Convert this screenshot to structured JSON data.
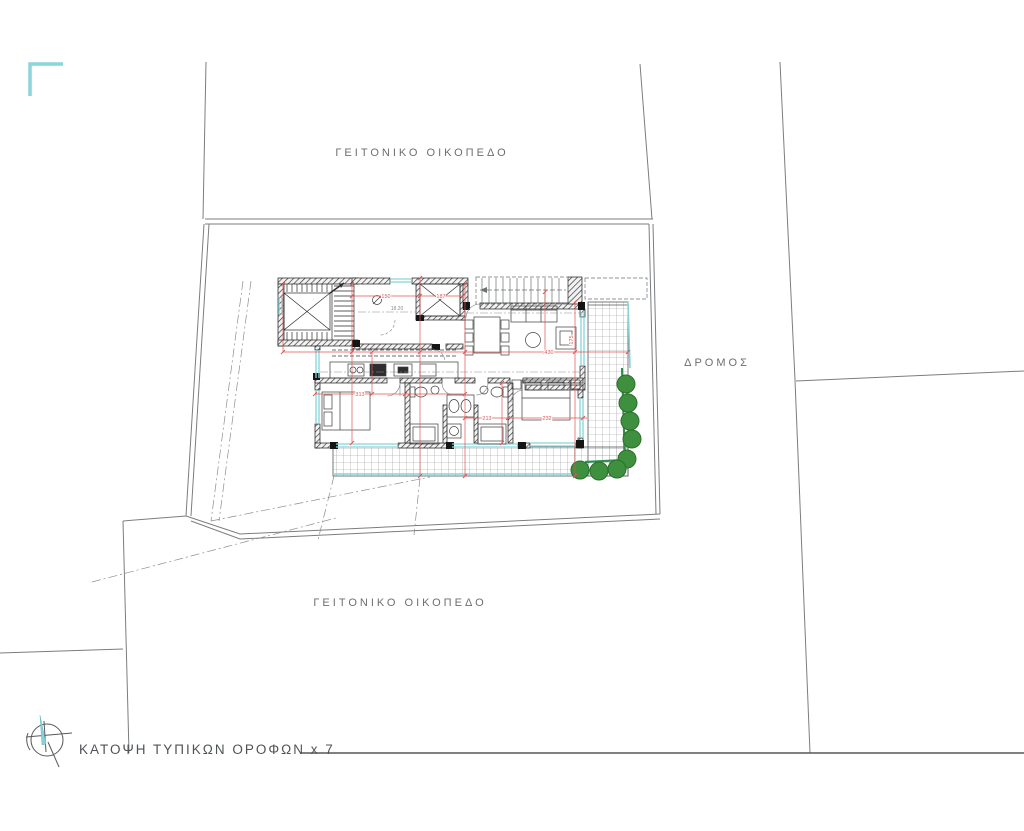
{
  "labels": {
    "neighbor_top": "ΓΕΙΤΟΝΙΚΟ ΟΙΚΟΠΕΔΟ",
    "neighbor_bottom": "ΓΕΙΤΟΝΙΚΟ ΟΙΚΟΠΕΔΟ",
    "road": "ΔΡΟΜΟΣ",
    "title": "ΚΑΤΟΨΗ ΤΥΠΙΚΩΝ ΟΡΟΦΩΝ x 7"
  },
  "plan": {
    "hall_area": "18.20",
    "dims": {
      "a": "150",
      "b": "187",
      "c": "430",
      "d": "313",
      "e": "213",
      "f": "232",
      "g": "175"
    }
  },
  "colors": {
    "accent_teal": "#86d4d8",
    "railing_green": "#2f8f4f",
    "tree_green": "#3e8f3e",
    "dimension_red": "#e05555",
    "boundary_gray": "#7a7d80",
    "wall_dark": "#1c1c1c",
    "text_gray": "#6b6f72"
  }
}
